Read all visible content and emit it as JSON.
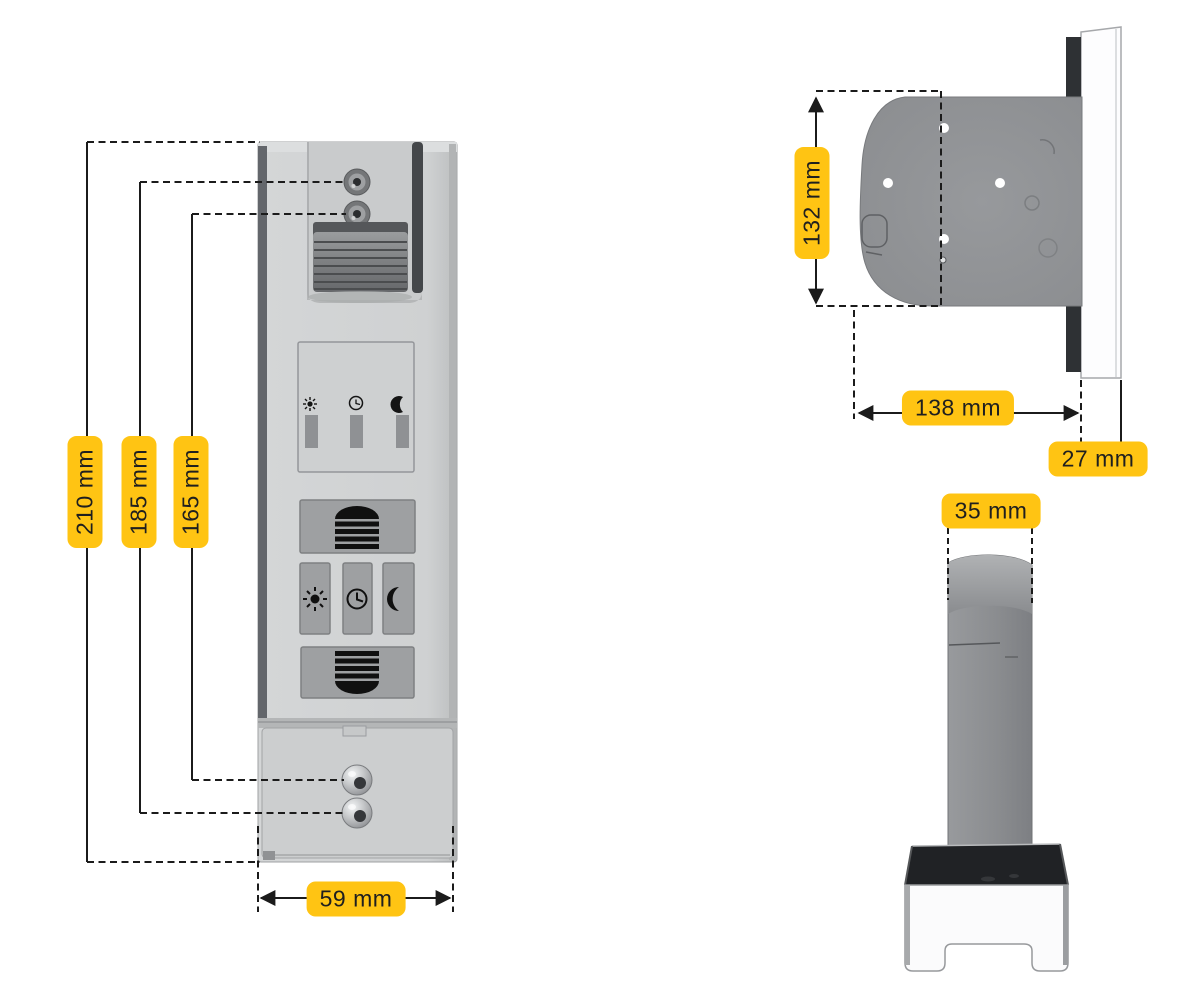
{
  "diagram": {
    "type": "product-dimension-drawing",
    "views": [
      "front",
      "top",
      "side"
    ]
  },
  "labels": {
    "d210": "210 mm",
    "d185": "185 mm",
    "d165": "165 mm",
    "d59": "59 mm",
    "d132": "132 mm",
    "d138": "138 mm",
    "d27": "27 mm",
    "d35": "35 mm"
  },
  "icons": {
    "display_row": [
      "sun-icon",
      "clock-icon",
      "moon-icon"
    ],
    "buttons": [
      "shutter-up-icon",
      "sun-icon",
      "clock-icon",
      "moon-icon",
      "shutter-down-icon"
    ]
  },
  "colors": {
    "label_bg": "#FFC413",
    "label_text": "#1F1F1F",
    "dimension_line": "#1B1B1B",
    "device_light_gray": "#D0D2D3",
    "device_button_gray": "#9EA0A2",
    "device_dark_gray": "#2F3134",
    "panel_white": "#FDFDFE"
  }
}
